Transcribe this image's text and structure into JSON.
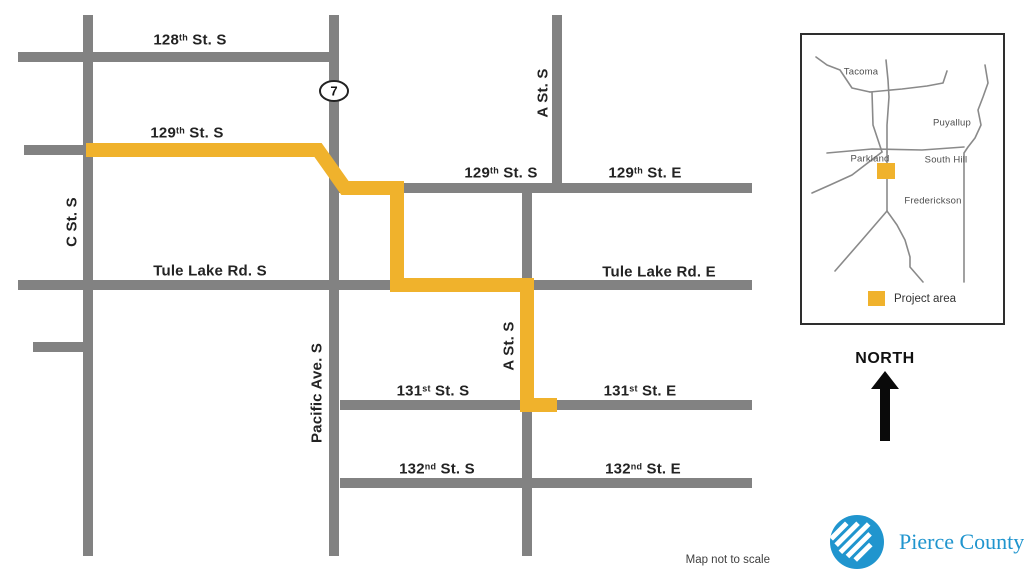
{
  "canvas": {
    "width": 1024,
    "height": 580
  },
  "colors": {
    "road": "#828282",
    "route": "#F0B22C",
    "label": "#232323",
    "inset_road": "#8a8a8a",
    "shield_fill": "#ffffff",
    "shield_border": "#222222",
    "logo_blue": "#2095ce"
  },
  "main_map": {
    "road_width": 10,
    "roads": [
      {
        "name": "128th-st-s",
        "x1": 18,
        "y1": 57,
        "x2": 334,
        "y2": 57
      },
      {
        "name": "129th-st-s-west-stub",
        "x1": 24,
        "y1": 150,
        "x2": 88,
        "y2": 150
      },
      {
        "name": "129th-st",
        "x1": 334,
        "y1": 188,
        "x2": 752,
        "y2": 188
      },
      {
        "name": "tule-lake-rd",
        "x1": 18,
        "y1": 285,
        "x2": 752,
        "y2": 285
      },
      {
        "name": "unnamed-stub",
        "x1": 33,
        "y1": 347,
        "x2": 88,
        "y2": 347
      },
      {
        "name": "131st-st",
        "x1": 340,
        "y1": 405,
        "x2": 752,
        "y2": 405
      },
      {
        "name": "132nd-st",
        "x1": 340,
        "y1": 483,
        "x2": 752,
        "y2": 483
      },
      {
        "name": "c-st-s",
        "x1": 88,
        "y1": 15,
        "x2": 88,
        "y2": 556
      },
      {
        "name": "pacific-ave-s",
        "x1": 334,
        "y1": 15,
        "x2": 334,
        "y2": 556
      },
      {
        "name": "a-st-s-north",
        "x1": 557,
        "y1": 15,
        "x2": 557,
        "y2": 188
      },
      {
        "name": "a-st-s-south",
        "x1": 527,
        "y1": 188,
        "x2": 527,
        "y2": 556
      }
    ],
    "project_route": {
      "width": 14,
      "points": [
        [
          86,
          150
        ],
        [
          318,
          150
        ],
        [
          345,
          188
        ],
        [
          397,
          188
        ],
        [
          397,
          285
        ],
        [
          527,
          285
        ],
        [
          527,
          405
        ],
        [
          557,
          405
        ]
      ]
    },
    "shield": {
      "label": "7",
      "cx": 334,
      "cy": 91,
      "rx": 14,
      "ry": 10
    },
    "labels": [
      {
        "name": "label-128th-st-s",
        "prefix": "128",
        "sup": "th",
        "suffix": " St. S",
        "x": 190,
        "y": 40,
        "rotate": false
      },
      {
        "name": "label-129th-st-s-west",
        "prefix": "129",
        "sup": "th",
        "suffix": " St. S",
        "x": 187,
        "y": 133,
        "rotate": false
      },
      {
        "name": "label-129th-st-s",
        "prefix": "129",
        "sup": "th",
        "suffix": " St. S",
        "x": 501,
        "y": 173,
        "rotate": false
      },
      {
        "name": "label-129th-st-e",
        "prefix": "129",
        "sup": "th",
        "suffix": " St. E",
        "x": 645,
        "y": 173,
        "rotate": false
      },
      {
        "name": "label-tule-lake-rd-s",
        "prefix": "Tule Lake Rd. S",
        "sup": "",
        "suffix": "",
        "x": 210,
        "y": 271,
        "rotate": false
      },
      {
        "name": "label-tule-lake-rd-e",
        "prefix": "Tule Lake Rd. E",
        "sup": "",
        "suffix": "",
        "x": 659,
        "y": 272,
        "rotate": false
      },
      {
        "name": "label-131st-st-s",
        "prefix": "131",
        "sup": "st",
        "suffix": " St. S",
        "x": 433,
        "y": 391,
        "rotate": false
      },
      {
        "name": "label-131st-st-e",
        "prefix": "131",
        "sup": "st",
        "suffix": " St. E",
        "x": 640,
        "y": 391,
        "rotate": false
      },
      {
        "name": "label-132nd-st-s",
        "prefix": "132",
        "sup": "nd",
        "suffix": " St. S",
        "x": 437,
        "y": 469,
        "rotate": false
      },
      {
        "name": "label-132nd-st-e",
        "prefix": "132",
        "sup": "nd",
        "suffix": " St. E",
        "x": 643,
        "y": 469,
        "rotate": false
      },
      {
        "name": "label-c-st-s",
        "prefix": "C St. S",
        "sup": "",
        "suffix": "",
        "x": 72,
        "y": 222,
        "rotate": true
      },
      {
        "name": "label-pacific-ave-s",
        "prefix": "Pacific Ave. S",
        "sup": "",
        "suffix": "",
        "x": 317,
        "y": 393,
        "rotate": true
      },
      {
        "name": "label-a-st-s-north",
        "prefix": "A St. S",
        "sup": "",
        "suffix": "",
        "x": 543,
        "y": 93,
        "rotate": true
      },
      {
        "name": "label-a-st-s-south",
        "prefix": "A St. S",
        "sup": "",
        "suffix": "",
        "x": 509,
        "y": 346,
        "rotate": true
      }
    ]
  },
  "inset": {
    "roads": [
      {
        "name": "inset-road-tacoma-squiggle",
        "points": [
          [
            14,
            22
          ],
          [
            25,
            30
          ],
          [
            38,
            35
          ],
          [
            44,
            44
          ],
          [
            50,
            53
          ],
          [
            68,
            57
          ]
        ]
      },
      {
        "name": "inset-road-sr7-upper",
        "points": [
          [
            84,
            25
          ],
          [
            86,
            45
          ],
          [
            87,
            62
          ],
          [
            85,
            90
          ],
          [
            85,
            117
          ]
        ]
      },
      {
        "name": "inset-road-left-vertical",
        "points": [
          [
            70,
            57
          ],
          [
            71,
            90
          ],
          [
            76,
            105
          ],
          [
            80,
            117
          ]
        ]
      },
      {
        "name": "inset-road-east-horizontal",
        "points": [
          [
            68,
            57
          ],
          [
            100,
            54
          ],
          [
            125,
            51
          ],
          [
            141,
            48
          ],
          [
            145,
            36
          ]
        ]
      },
      {
        "name": "inset-road-puyallup-wavy",
        "points": [
          [
            183,
            30
          ],
          [
            186,
            48
          ],
          [
            181,
            62
          ],
          [
            176,
            75
          ],
          [
            179,
            90
          ],
          [
            173,
            103
          ],
          [
            166,
            112
          ],
          [
            162,
            118
          ],
          [
            162,
            247
          ]
        ]
      },
      {
        "name": "inset-road-south-hill-horizontal",
        "points": [
          [
            25,
            118
          ],
          [
            70,
            114
          ],
          [
            120,
            115
          ],
          [
            162,
            112
          ]
        ]
      },
      {
        "name": "inset-road-parkland-diagonal",
        "points": [
          [
            80,
            117
          ],
          [
            50,
            140
          ],
          [
            28,
            150
          ],
          [
            10,
            158
          ]
        ]
      },
      {
        "name": "inset-road-sr7-lower",
        "points": [
          [
            85,
            117
          ],
          [
            85,
            176
          ]
        ]
      },
      {
        "name": "inset-road-branch-southwest",
        "points": [
          [
            85,
            176
          ],
          [
            60,
            205
          ],
          [
            33,
            236
          ]
        ]
      },
      {
        "name": "inset-road-branch-southeast",
        "points": [
          [
            85,
            176
          ],
          [
            95,
            190
          ],
          [
            103,
            205
          ],
          [
            108,
            222
          ],
          [
            108,
            232
          ],
          [
            121,
            247
          ]
        ]
      }
    ],
    "labels": [
      {
        "name": "inset-label-tacoma",
        "text": "Tacoma",
        "x": 59,
        "y": 37
      },
      {
        "name": "inset-label-puyallup",
        "text": "Puyallup",
        "x": 150,
        "y": 88
      },
      {
        "name": "inset-label-parkland",
        "text": "Parkland",
        "x": 68,
        "y": 124
      },
      {
        "name": "inset-label-south-hill",
        "text": "South Hill",
        "x": 144,
        "y": 125
      },
      {
        "name": "inset-label-frederickson",
        "text": "Frederickson",
        "x": 131,
        "y": 166
      }
    ],
    "marker": {
      "x": 75,
      "y": 128,
      "w": 18,
      "h": 16
    },
    "legend": {
      "label": "Project area"
    }
  },
  "north": {
    "label": "NORTH"
  },
  "footer": {
    "note": "Map not to scale"
  },
  "logo": {
    "text": "Pierce County"
  }
}
